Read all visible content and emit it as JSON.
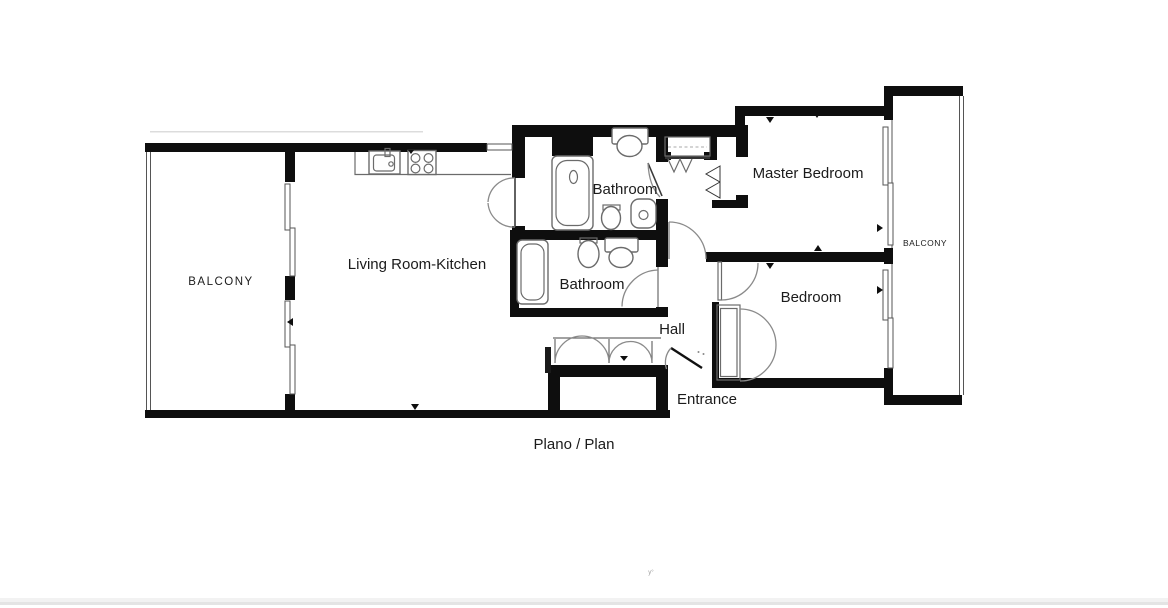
{
  "caption": "Plano / Plan",
  "rooms": {
    "balcony_left": "BALCONY",
    "living_kitchen": "Living Room-Kitchen",
    "bathroom_top": "Bathroom",
    "bathroom_bottom": "Bathroom",
    "hall": "Hall",
    "entrance": "Entrance",
    "master_bedroom": "Master Bedroom",
    "bedroom": "Bedroom",
    "balcony_right": "BALCONY"
  },
  "misc": {
    "tiny_mark": "y°"
  },
  "colors": {
    "wall": "#0e0e0e",
    "line": "#555555",
    "fixture": "#6b6b6b",
    "label": "#1b1b1b",
    "bottom_bar": "#f2f2f2",
    "bottom_bar_edge": "#e4e4e4"
  }
}
